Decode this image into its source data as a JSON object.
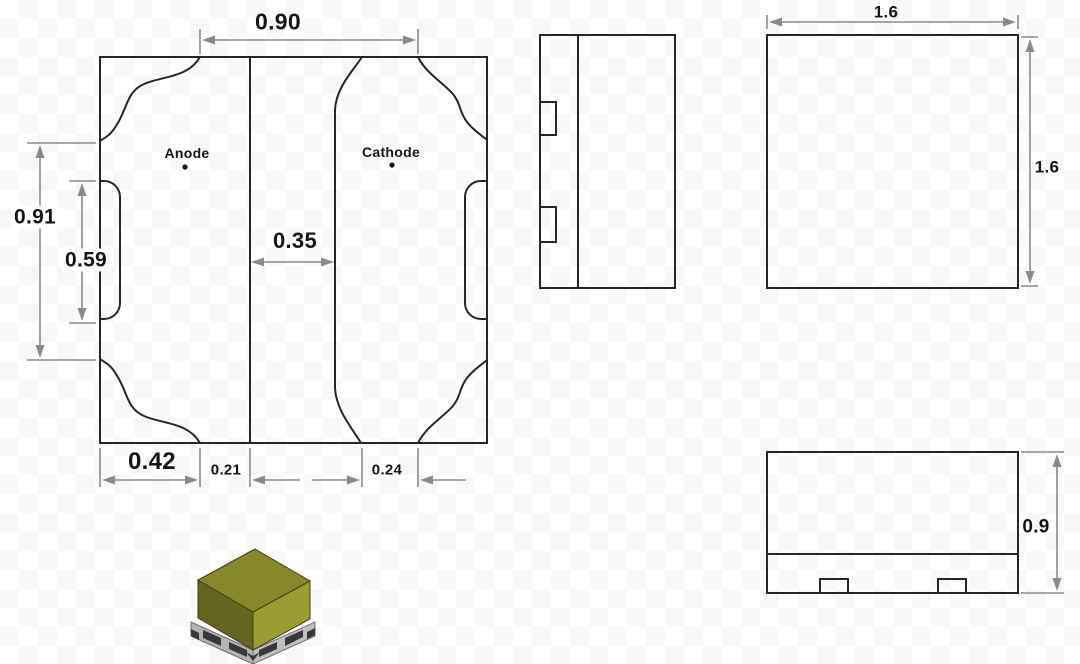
{
  "drawing": {
    "land_pattern": {
      "anode_label": "Anode",
      "cathode_label": "Cathode",
      "dim_top_width": "0.90",
      "dim_left_outer": "0.91",
      "dim_left_inner": "0.59",
      "dim_pad_gap": "0.35",
      "dim_bottom_left": "0.42",
      "dim_bottom_center": "0.21",
      "dim_bottom_right": "0.24"
    },
    "top_view": {
      "dim_width": "1.6",
      "dim_height": "1.6"
    },
    "front_view": {
      "dim_height": "0.9"
    }
  },
  "colors": {
    "outline": "#262626",
    "dimension": "#8a8a8a",
    "label": "#151515",
    "chip_top": "#87872b",
    "chip_left": "#65651f",
    "chip_right": "#9c9c33",
    "chip_base_left": "#b4b4b4",
    "chip_base_right": "#c0c0c0",
    "chip_contact": "#383838"
  }
}
